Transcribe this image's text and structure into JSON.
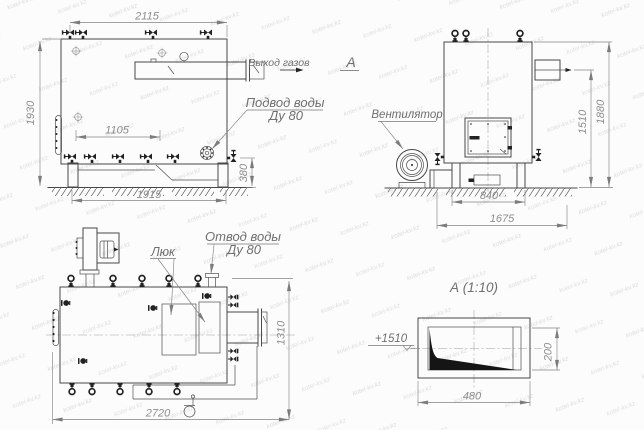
{
  "meta": {
    "background": "#fcfcfc",
    "line_color": "#474747",
    "dimension_color": "#8d8d8d",
    "label_color": "#6f6f6f",
    "watermark_text": "kotel-kv.kz"
  },
  "side_view": {
    "dim_width_top": "2115",
    "dim_height_left": "1930",
    "dim_nozzle_span": "1105",
    "dim_base_width": "1915",
    "dim_right_height": "380",
    "label_gas_outlet": "Выход газов",
    "label_section_mark": "А",
    "label_water_supply_line1": "Подвод воды",
    "label_water_supply_line2": "Ду 80"
  },
  "front_view": {
    "label_fan": "Вентилятор",
    "dim_burner_axis_height": "1510",
    "dim_total_height": "1880",
    "dim_base_width": "840",
    "dim_total_depth": "1675"
  },
  "top_view": {
    "label_hatch": "Люк",
    "label_water_outlet_line1": "Отвод воды",
    "label_water_outlet_line2": "Ду 80",
    "dim_length": "2720",
    "dim_width": "1310"
  },
  "detail_view": {
    "title": "А (1:10)",
    "label_elevation": "+1510",
    "dim_width": "480",
    "dim_height": "200"
  }
}
